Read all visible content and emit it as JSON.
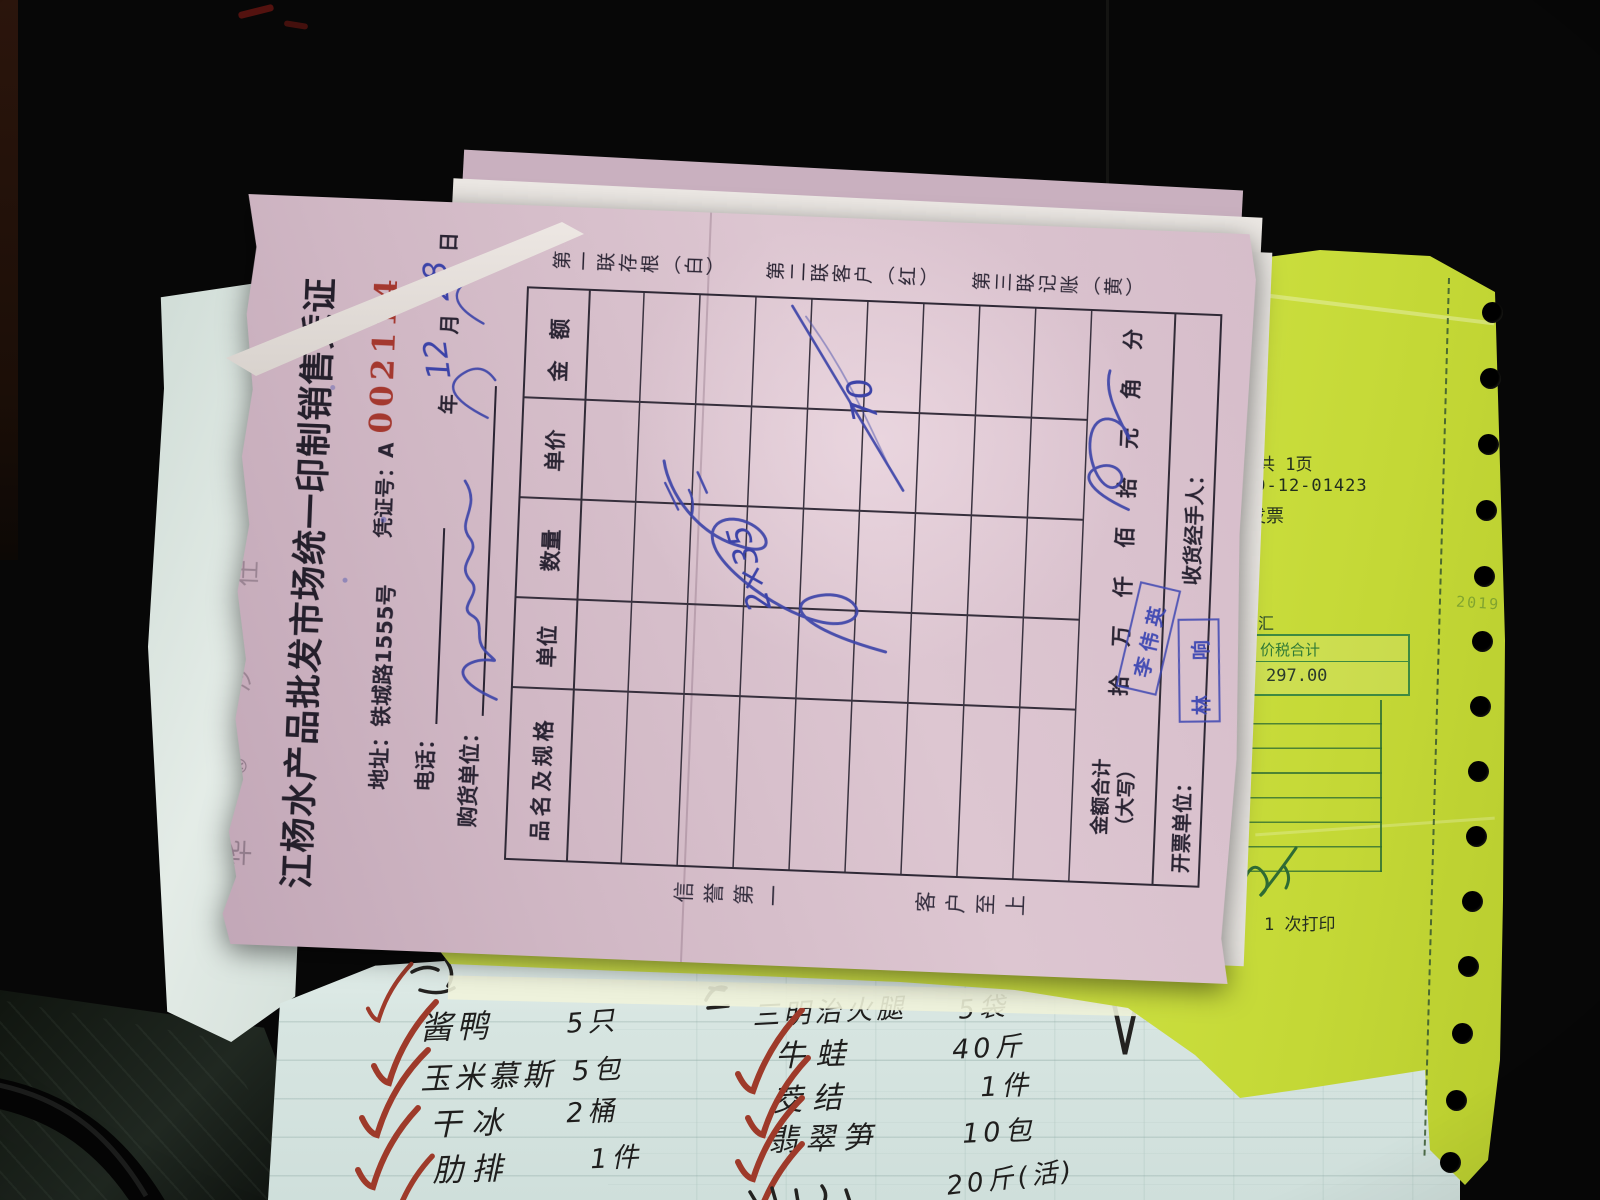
{
  "photo": {
    "paper_pink": "#d6bdca",
    "paper_yellow": "#d3e647",
    "paper_cyan": "#d8e6e2",
    "serial_red": "#a4382f",
    "ink_blue": "#3c43a8",
    "stamp_blue": "#3d47b2"
  },
  "form": {
    "faint": {
      "a": "华",
      "b": "沙",
      "c": "仕"
    },
    "reg_mark": "®",
    "title": "江杨水产品批发市场统一印制销售凭证",
    "address": "地址：铁城路1555号",
    "phone_label": "电话：",
    "buyer_label": "购货单位：",
    "voucher_label": "凭证号：A",
    "voucher_number": "002114",
    "year": "年",
    "month": "月",
    "day": "日",
    "hw_month": "12",
    "hw_day": "28",
    "copies": [
      "第一联存根（白）",
      "第二联客户（红）",
      "第三联记账（黄）"
    ],
    "headers": [
      "品名及规格",
      "单位",
      "数量",
      "单价",
      "金　额"
    ],
    "hw_price": "2×35",
    "hw_amount": "70",
    "total_label_1": "金额合计",
    "total_label_2": "（大写）",
    "digits": [
      "拾",
      "万",
      "仟",
      "佰",
      "拾",
      "元",
      "角",
      "分"
    ],
    "issuer": "开票单位：",
    "receiver": "收货经手人：",
    "slogan_1": "信誉第一",
    "slogan_2": "客户至上",
    "stamp_1": "李伟英",
    "stamp_2": "林 响"
  },
  "yellow": {
    "pages": "共 1页",
    "number": "19-12-01423",
    "line_invoice": "税发票",
    "line_district": "徐汇",
    "total_label": "价税合计",
    "total_value": "297.00",
    "print_note": "1 次打印",
    "faint_year": "2019"
  },
  "list": {
    "left": [
      [
        "酱鸭",
        "5只"
      ],
      [
        "玉米慕斯",
        "5包"
      ],
      [
        "干冰",
        "2桶"
      ],
      [
        "肋排",
        "1件"
      ]
    ],
    "right": [
      [
        "三明治火腿",
        "5袋"
      ],
      [
        "牛蛙",
        "40斤"
      ],
      [
        "茭结",
        "1件"
      ],
      [
        "翡翠笋",
        "10包"
      ]
    ],
    "partial_qty": "20斤(活)"
  }
}
